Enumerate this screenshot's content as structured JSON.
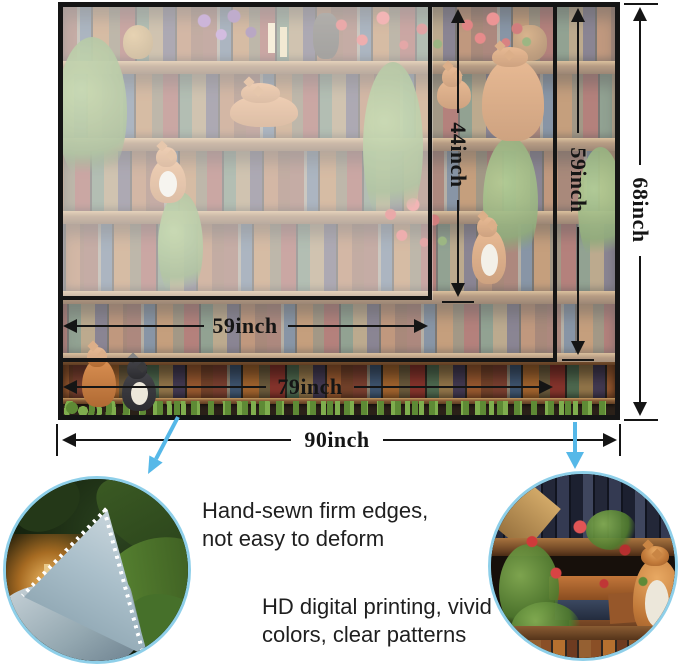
{
  "size_diagram": {
    "vertical": {
      "d44": "44inch",
      "d59": "59inch",
      "d68": "68inch"
    },
    "horizontal": {
      "d59": "59inch",
      "d79": "79inch",
      "d90": "90inch"
    }
  },
  "features": {
    "edges": {
      "line1": "Hand-sewn firm edges,",
      "line2": "not easy to deform"
    },
    "printing": {
      "line1": "HD digital printing, vivid",
      "line2": "colors, clear patterns"
    }
  },
  "colors": {
    "dimension_ink": "#151515",
    "callout_arrow_blue": "#56b8e8",
    "circle_ring_blue": "#8ecfe9"
  },
  "photos": {
    "artwork": "bookshelf-painting-with-cats-and-plants",
    "left_circle": "fabric-corner-close-up",
    "right_circle": "print-detail-close-up"
  }
}
